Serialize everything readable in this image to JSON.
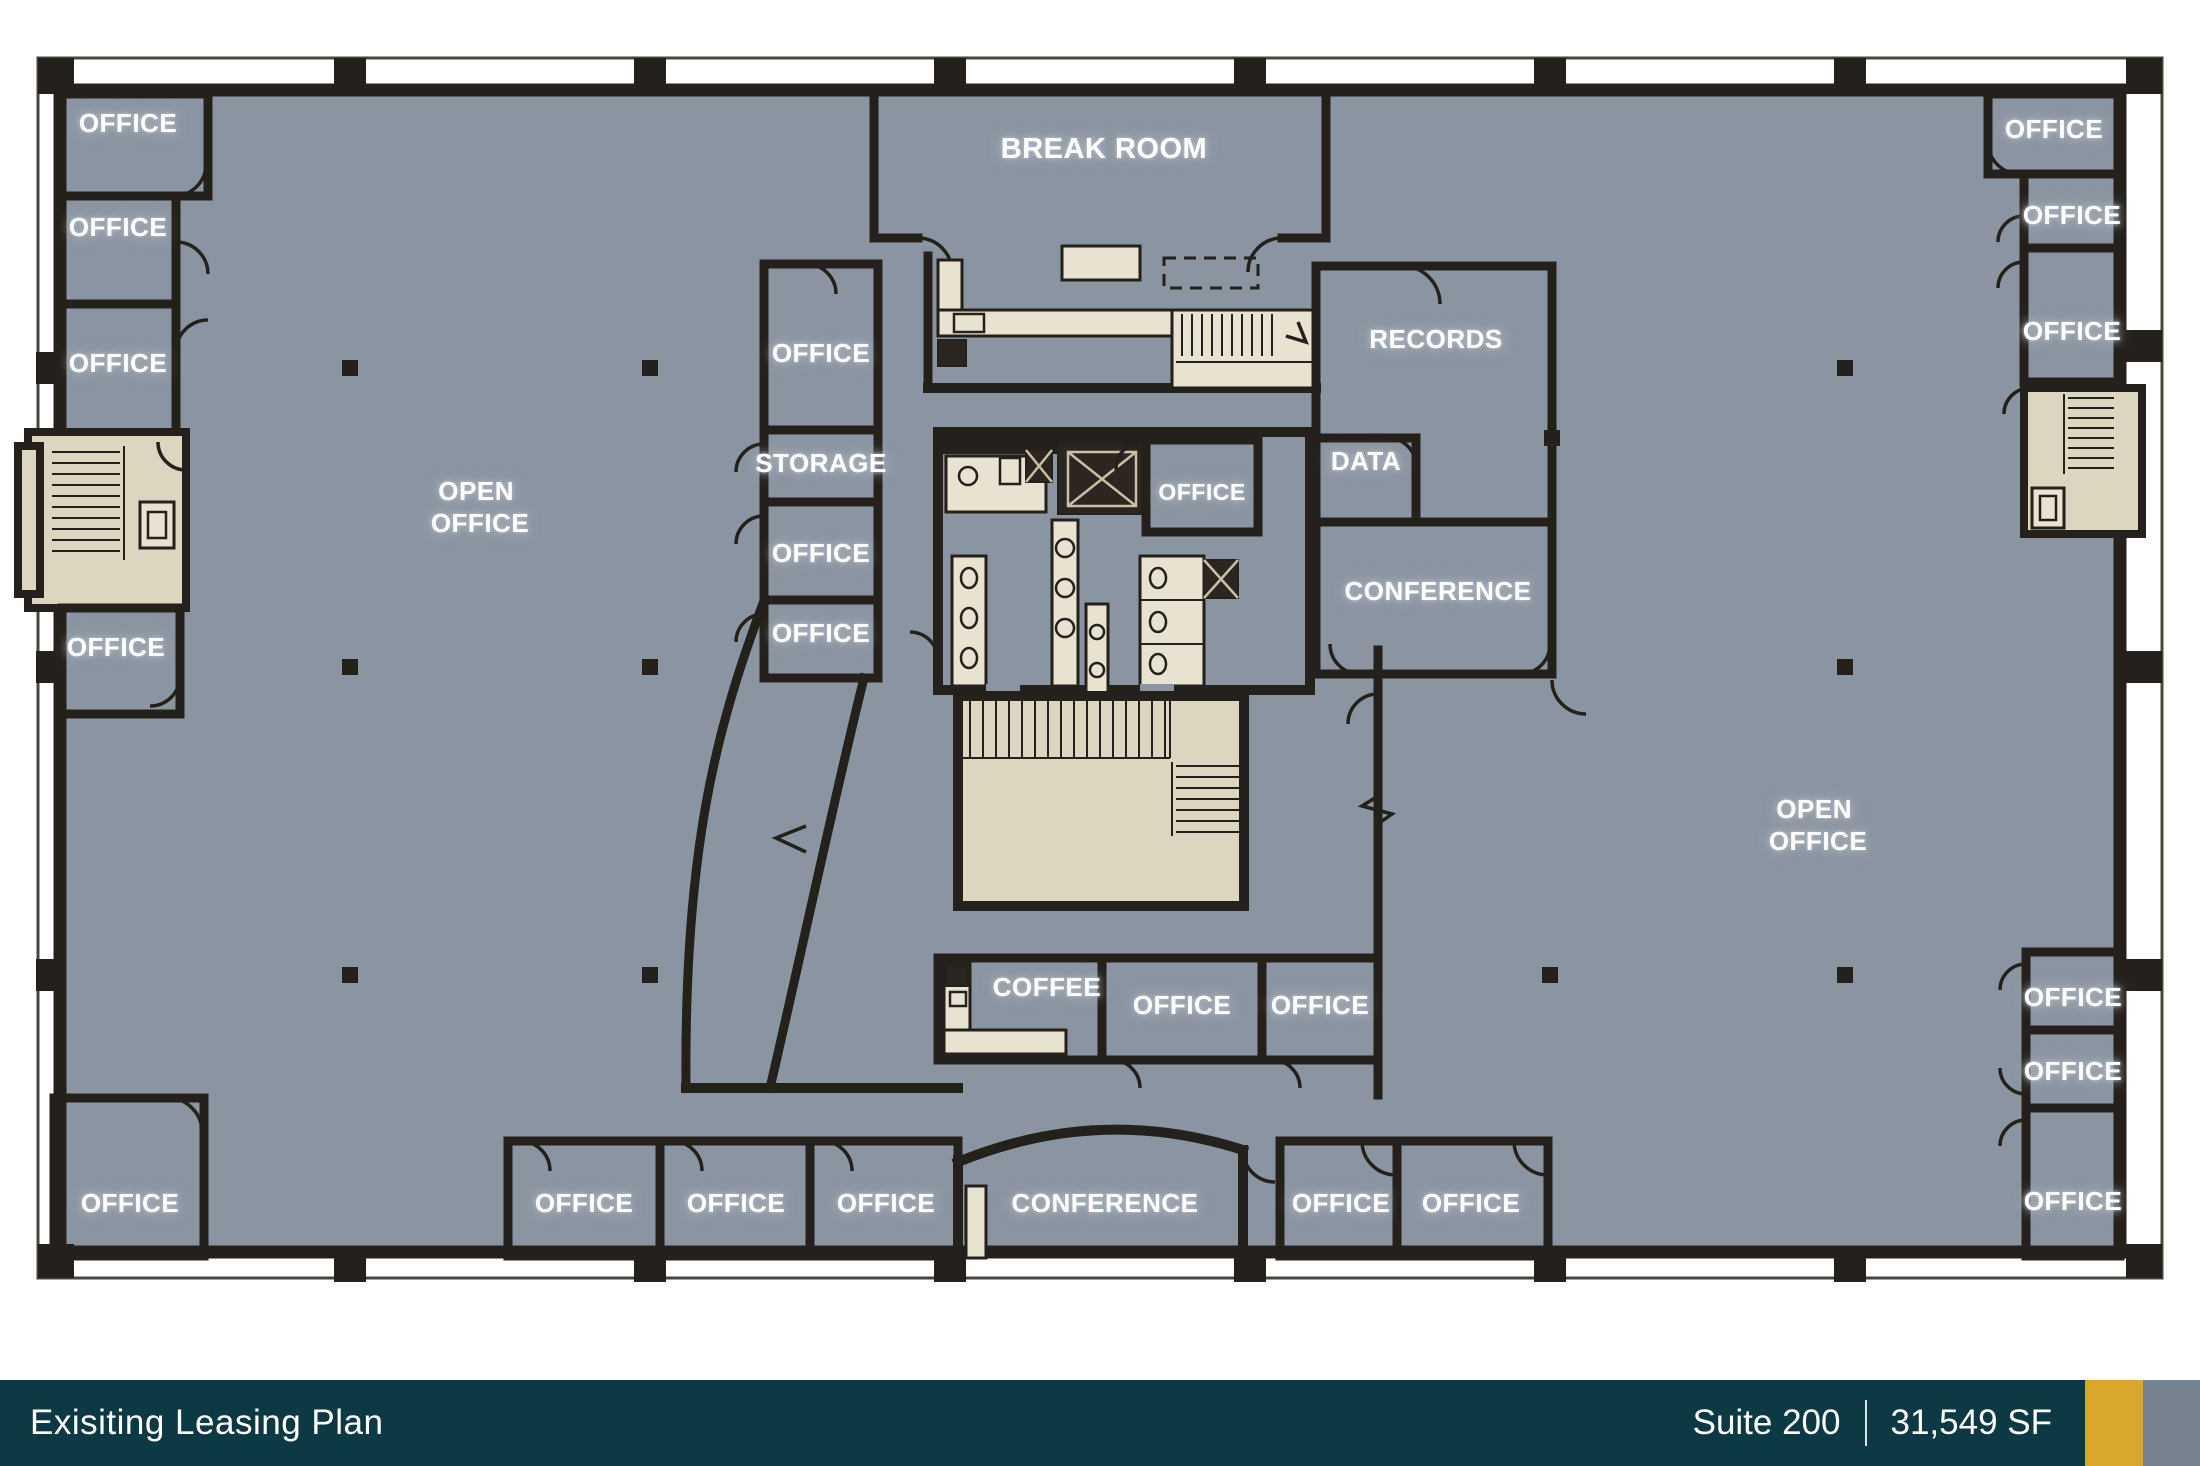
{
  "labels": {
    "office": "OFFICE",
    "open": "OPEN",
    "open2": "OFFICE",
    "break_room": "BREAK ROOM",
    "storage": "STORAGE",
    "records": "RECORDS",
    "data": "DATA",
    "conference": "CONFERENCE",
    "coffee": "COFFEE"
  },
  "footer": {
    "title": "Exisiting Leasing Plan",
    "suite": "Suite 200",
    "divider": "|",
    "area": "31,549 SF"
  },
  "colors": {
    "floor": "#8B95A1",
    "walls": "#24201B",
    "core_beige": "#DCD5BF",
    "furniture_beige": "#E8E2D0",
    "footer_teal": "#0D3945",
    "accent_gold": "#D7A62B",
    "accent_gray": "#76828E",
    "label_text": "#FFFFFF"
  }
}
